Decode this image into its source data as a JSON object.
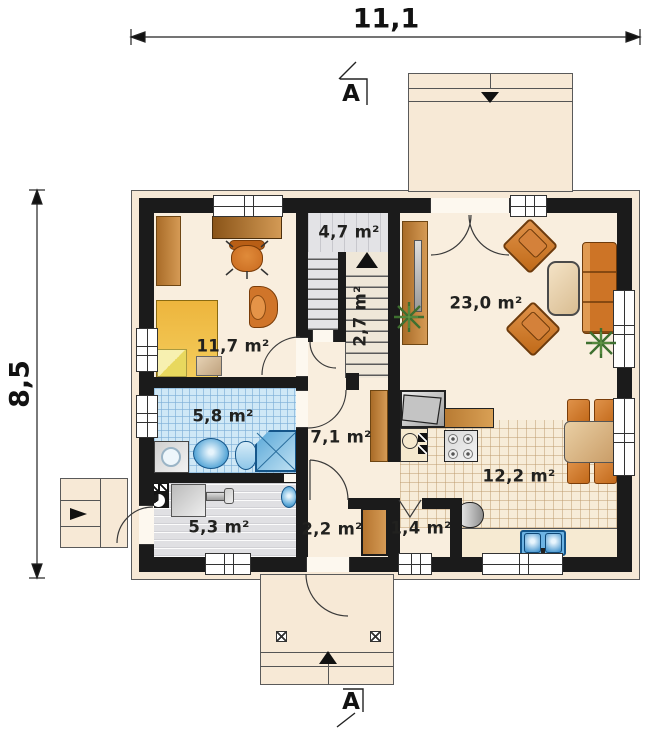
{
  "plan": {
    "dimensions": {
      "width_label": "11,1",
      "height_label": "8,5"
    },
    "section_label": "A",
    "rooms": {
      "bedroom": {
        "label": "11,7 m²"
      },
      "stair_hall": {
        "label": "4,7 m²"
      },
      "staircase": {
        "label": "2,7 m²"
      },
      "living_room": {
        "label": "23,0 m²"
      },
      "bathroom": {
        "label": "5,8 m²"
      },
      "hall": {
        "label": "7,1 m²"
      },
      "kitchen_dining": {
        "label": "12,2 m²"
      },
      "utility_room": {
        "label": "5,3 m²"
      },
      "entry": {
        "label": "2,2 m²"
      },
      "pantry": {
        "label": "1,4 m²"
      }
    },
    "colors": {
      "wall": "#1b1b1b",
      "exterior_band": "#f7e9d6",
      "floor": "#f9eede",
      "bathroom_tile": "#cfe8f6",
      "stair_floor": "#e3e3e6",
      "utility_floor": "#e0e0e3",
      "kitchen_tile": "#f7ecd8",
      "wood": "#c08a4a",
      "upholstery": "#d0762a",
      "bed": "#f2c84e",
      "fixture_blue": "#7fc0e8",
      "plant": "#3e7030"
    }
  }
}
